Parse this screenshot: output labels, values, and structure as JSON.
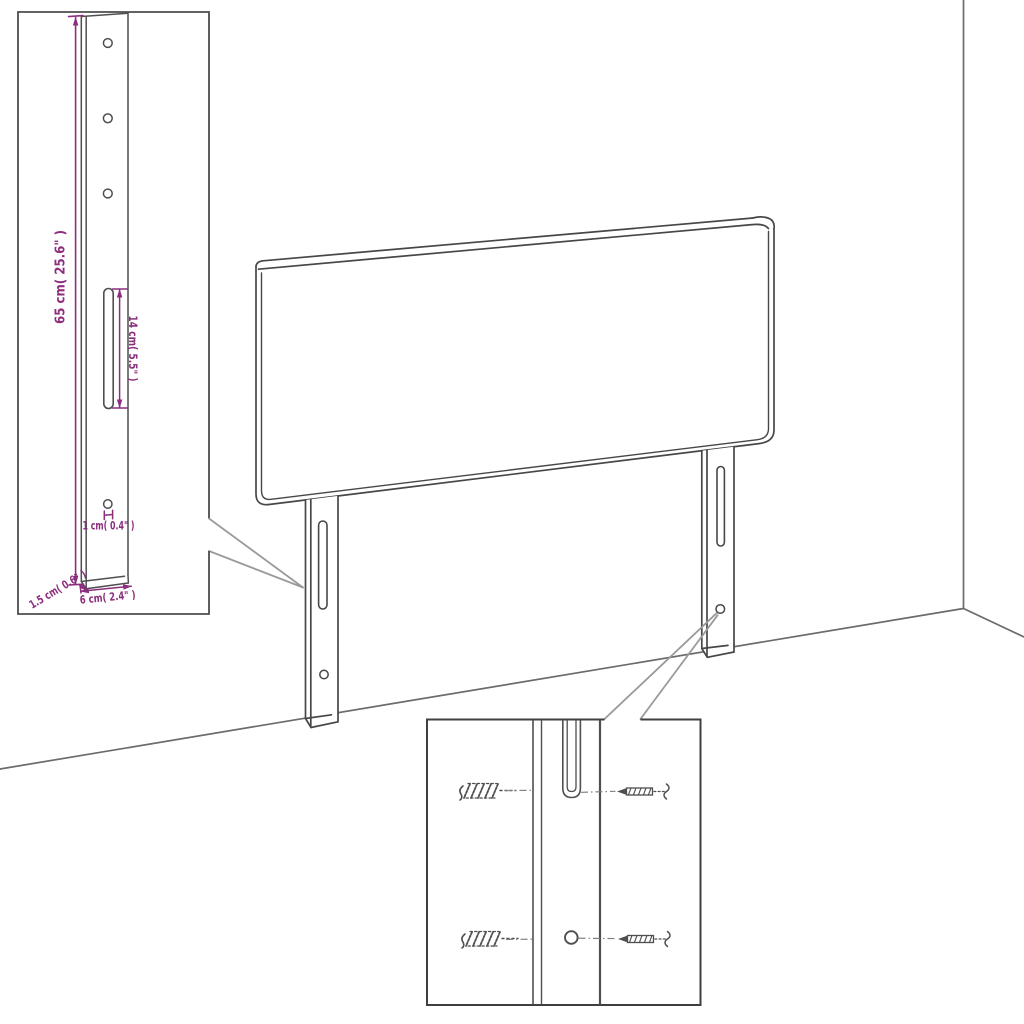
{
  "page": {
    "width": 1024,
    "height": 1024,
    "background": "#ffffff"
  },
  "diagram": {
    "kind": "furniture-assembly-dimension-diagram",
    "subject": "upholstered headboard with two mounting legs shown against a wall corner",
    "colors": {
      "dimension_accent": "#8c2e7d",
      "outline": "#4a4a4a",
      "callout": "#9a9a9a",
      "wall": "#6b6b6b"
    },
    "insets": {
      "bracket_detail": {
        "dimensions": {
          "leg_height": "65 cm( 25.6\" )",
          "slot_length": "14 cm( 5.5\" )",
          "hole_diameter": "1 cm( 0.4\" )",
          "leg_width": "6 cm( 2.4\" )",
          "leg_thickness": "1.5 cm( 0.6\" )"
        },
        "features": [
          "three-round-holes",
          "long-slot",
          "small-bottom-hole"
        ]
      },
      "hardware_detail": {
        "rows": 2,
        "items": [
          "wall-plug",
          "screw"
        ],
        "targets": [
          "leg-slot",
          "leg-hole"
        ]
      }
    }
  }
}
